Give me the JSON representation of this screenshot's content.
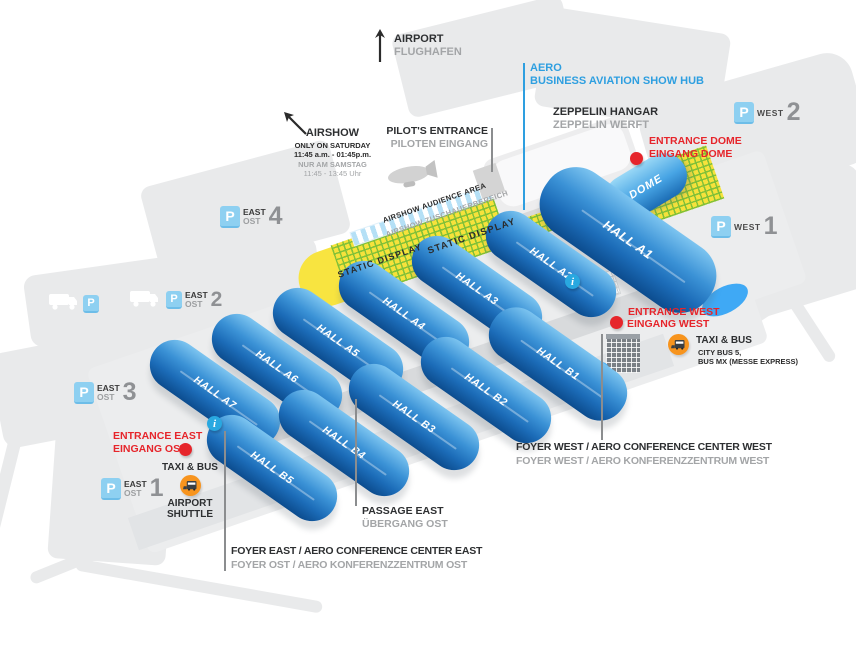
{
  "colors": {
    "hall_blue": "#2f88d0",
    "dome_blue": "#47a4e4",
    "aero_blue": "#2e9fe0",
    "entrance_red": "#e6252b",
    "taxi_orange": "#f7941e",
    "static_display_yellow": "#f6e23b",
    "hatch_green": "#7dbf38",
    "parking_icon_blue": "#8ed0f1",
    "text_gray": "#a3a5a7"
  },
  "icons": {
    "parking": "P",
    "info": "i"
  },
  "annotations": {
    "airport": {
      "en": "AIRPORT",
      "de": "FLUGHAFEN"
    },
    "aero": {
      "line1": "AERO",
      "line2": "BUSINESS AVIATION SHOW HUB"
    },
    "airshow": {
      "title": "AIRSHOW",
      "sub1": "ONLY ON SATURDAY",
      "sub2": "11:45 a.m. - 01:45p.m.",
      "sub3": "NUR AM SAMSTAG",
      "sub4": "11:45 - 13:45 Uhr"
    },
    "pilots_entrance": {
      "en": "PILOT'S ENTRANCE",
      "de": "PILOTEN EINGANG"
    },
    "zeppelin_hangar": {
      "en": "ZEPPELIN HANGAR",
      "de": "ZEPPELIN WERFT"
    },
    "entrance_dome": {
      "en": "ENTRANCE DOME",
      "de": "EINGANG DOME"
    },
    "entrance_west": {
      "en": "ENTRANCE WEST",
      "de": "EINGANG WEST"
    },
    "entrance_east": {
      "en": "ENTRANCE EAST",
      "de": "EINGANG OST"
    },
    "taxi_bus_west": {
      "title": "TAXI & BUS",
      "line1": "CITY BUS 5,",
      "line2": "BUS MX (MESSE EXPRESS)"
    },
    "taxi_bus_east": {
      "title": "TAXI & BUS",
      "line1": "AIRPORT",
      "line2": "SHUTTLE"
    },
    "audience_area": {
      "en": "AIRSHOW AUDIENCE AREA",
      "de": "AIRSHOW ZUSCHAUERBEREICH"
    },
    "static_display_upper": "STATIC DISPLAY",
    "static_display_lower": "STATIC DISPLAY",
    "dome": "DOME",
    "passage_east": {
      "en": "PASSAGE EAST",
      "de": "ÜBERGANG OST"
    },
    "foyer_east": {
      "en": "FOYER EAST / AERO CONFERENCE CENTER EAST",
      "de": "FOYER OST / AERO KONFERENZZENTRUM OST"
    },
    "foyer_west": {
      "en": "FOYER WEST / AERO CONFERENCE CENTER WEST",
      "de": "FOYER WEST / AERO KONFERENZZENTRUM WEST"
    }
  },
  "halls": [
    {
      "id": "a1",
      "label": "HALL A1"
    },
    {
      "id": "a2",
      "label": "HALL A2"
    },
    {
      "id": "a3",
      "label": "HALL A3"
    },
    {
      "id": "a4",
      "label": "HALL A4"
    },
    {
      "id": "a5",
      "label": "HALL A5"
    },
    {
      "id": "a6",
      "label": "HALL A6"
    },
    {
      "id": "a7",
      "label": "HALL A7"
    },
    {
      "id": "b1",
      "label": "HALL B1"
    },
    {
      "id": "b2",
      "label": "HALL B2"
    },
    {
      "id": "b3",
      "label": "HALL B3"
    },
    {
      "id": "b4",
      "label": "HALL B4"
    },
    {
      "id": "b5",
      "label": "HALL B5"
    }
  ],
  "parking": [
    {
      "id": "west-2",
      "area": "WEST",
      "number": "2"
    },
    {
      "id": "west-1",
      "area": "WEST",
      "number": "1"
    },
    {
      "id": "east-4",
      "area": "EAST",
      "area_de": "OST",
      "number": "4"
    },
    {
      "id": "east-2",
      "area": "EAST",
      "area_de": "OST",
      "number": "2"
    },
    {
      "id": "east-3",
      "area": "EAST",
      "area_de": "OST",
      "number": "3"
    },
    {
      "id": "east-1",
      "area": "EAST",
      "area_de": "OST",
      "number": "1"
    }
  ]
}
